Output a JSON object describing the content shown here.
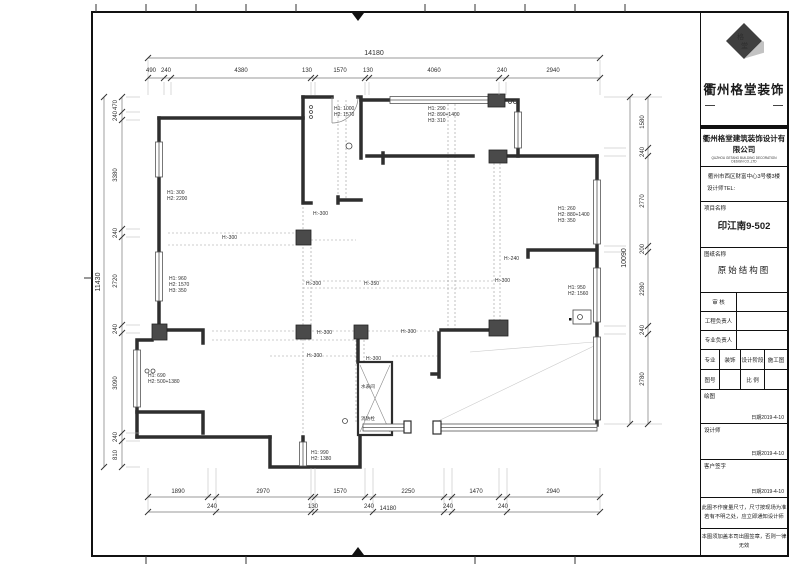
{
  "title_block": {
    "brand": "衢州格堂装饰",
    "company": "衢州格堂建筑装饰设计有限公司",
    "company_en": "QUZHOU GETANG BUILDING DECORATION DESIGN CO.,LTD",
    "address": "衢州市西区财富中心3号楼3楼",
    "tel_label": "设计师TEL:",
    "project_label": "项目名称",
    "project_name": "印江南9-502",
    "drawing_label": "图纸名称",
    "drawing_name": "原始结构图",
    "review_label": "审 核",
    "eng_lead_label": "工程负责人",
    "pro_lead_label": "专业负责人",
    "discipline_label": "专业",
    "discipline_value": "装饰",
    "stage_label": "设计阶段",
    "stage_value": "施工图",
    "sheet_no_label": "图号",
    "scale_label": "比 例",
    "draw_label": "绘图",
    "designer_label": "设计师",
    "client_label": "客户签字",
    "date_label": "日期",
    "draw_date": "2019-4-10",
    "designer_date": "2019-4-10",
    "client_date": "2019-4-10",
    "note1a": "此图不作度量尺寸，尺寸按现场为准",
    "note1b": "若有不明之处，应立即通知设计师",
    "note2": "本图须加盖本司出图签章，否则一律无效"
  },
  "dims": {
    "top_total": "14180",
    "top": [
      "490",
      "240",
      "4380",
      "130",
      "1570",
      "130",
      "4060",
      "240",
      "2940"
    ],
    "bottom1": [
      "1890",
      "2970",
      "1570",
      "2250",
      "1470",
      "2940"
    ],
    "bottom2": [
      "240",
      "130",
      "240",
      "240",
      "240"
    ],
    "bottom_total": "14180",
    "left_total": "11430",
    "left": [
      "470",
      "240",
      "3380",
      "240",
      "2720",
      "240",
      "3090",
      "240",
      "810"
    ],
    "right_total": "10090",
    "right": [
      "1580",
      "240",
      "2770",
      "200",
      "2280",
      "240",
      "2780"
    ]
  },
  "plan_labels": {
    "h300": "H:-300",
    "h350": "H:-350",
    "h240": "H:-240",
    "entry_win": [
      "H1: 1000",
      "H2: 1570"
    ],
    "tr_win": [
      "H1: 290",
      "H2: 890+1400",
      "H3: 310"
    ],
    "r_win": [
      "H1: 260",
      "H2: 880+1400",
      "H3: 350"
    ],
    "l_win1": [
      "H1: 300",
      "H2: 2200"
    ],
    "l_win2": [
      "H1: 960",
      "H2: 1570",
      "H3: 350"
    ],
    "l_win3": [
      "H1: 690",
      "H2: 500+1380"
    ],
    "b_win": [
      "H1: 990",
      "H2: 1380"
    ],
    "rb_win": [
      "H1: 950",
      "H2: 1560"
    ],
    "shaft1": "水表间",
    "shaft2": "消防栓"
  },
  "colors": {
    "wall": "#2e2e2e",
    "column": "#4a4a4a",
    "dim": "#555555",
    "grid": "#9a9a9a"
  }
}
